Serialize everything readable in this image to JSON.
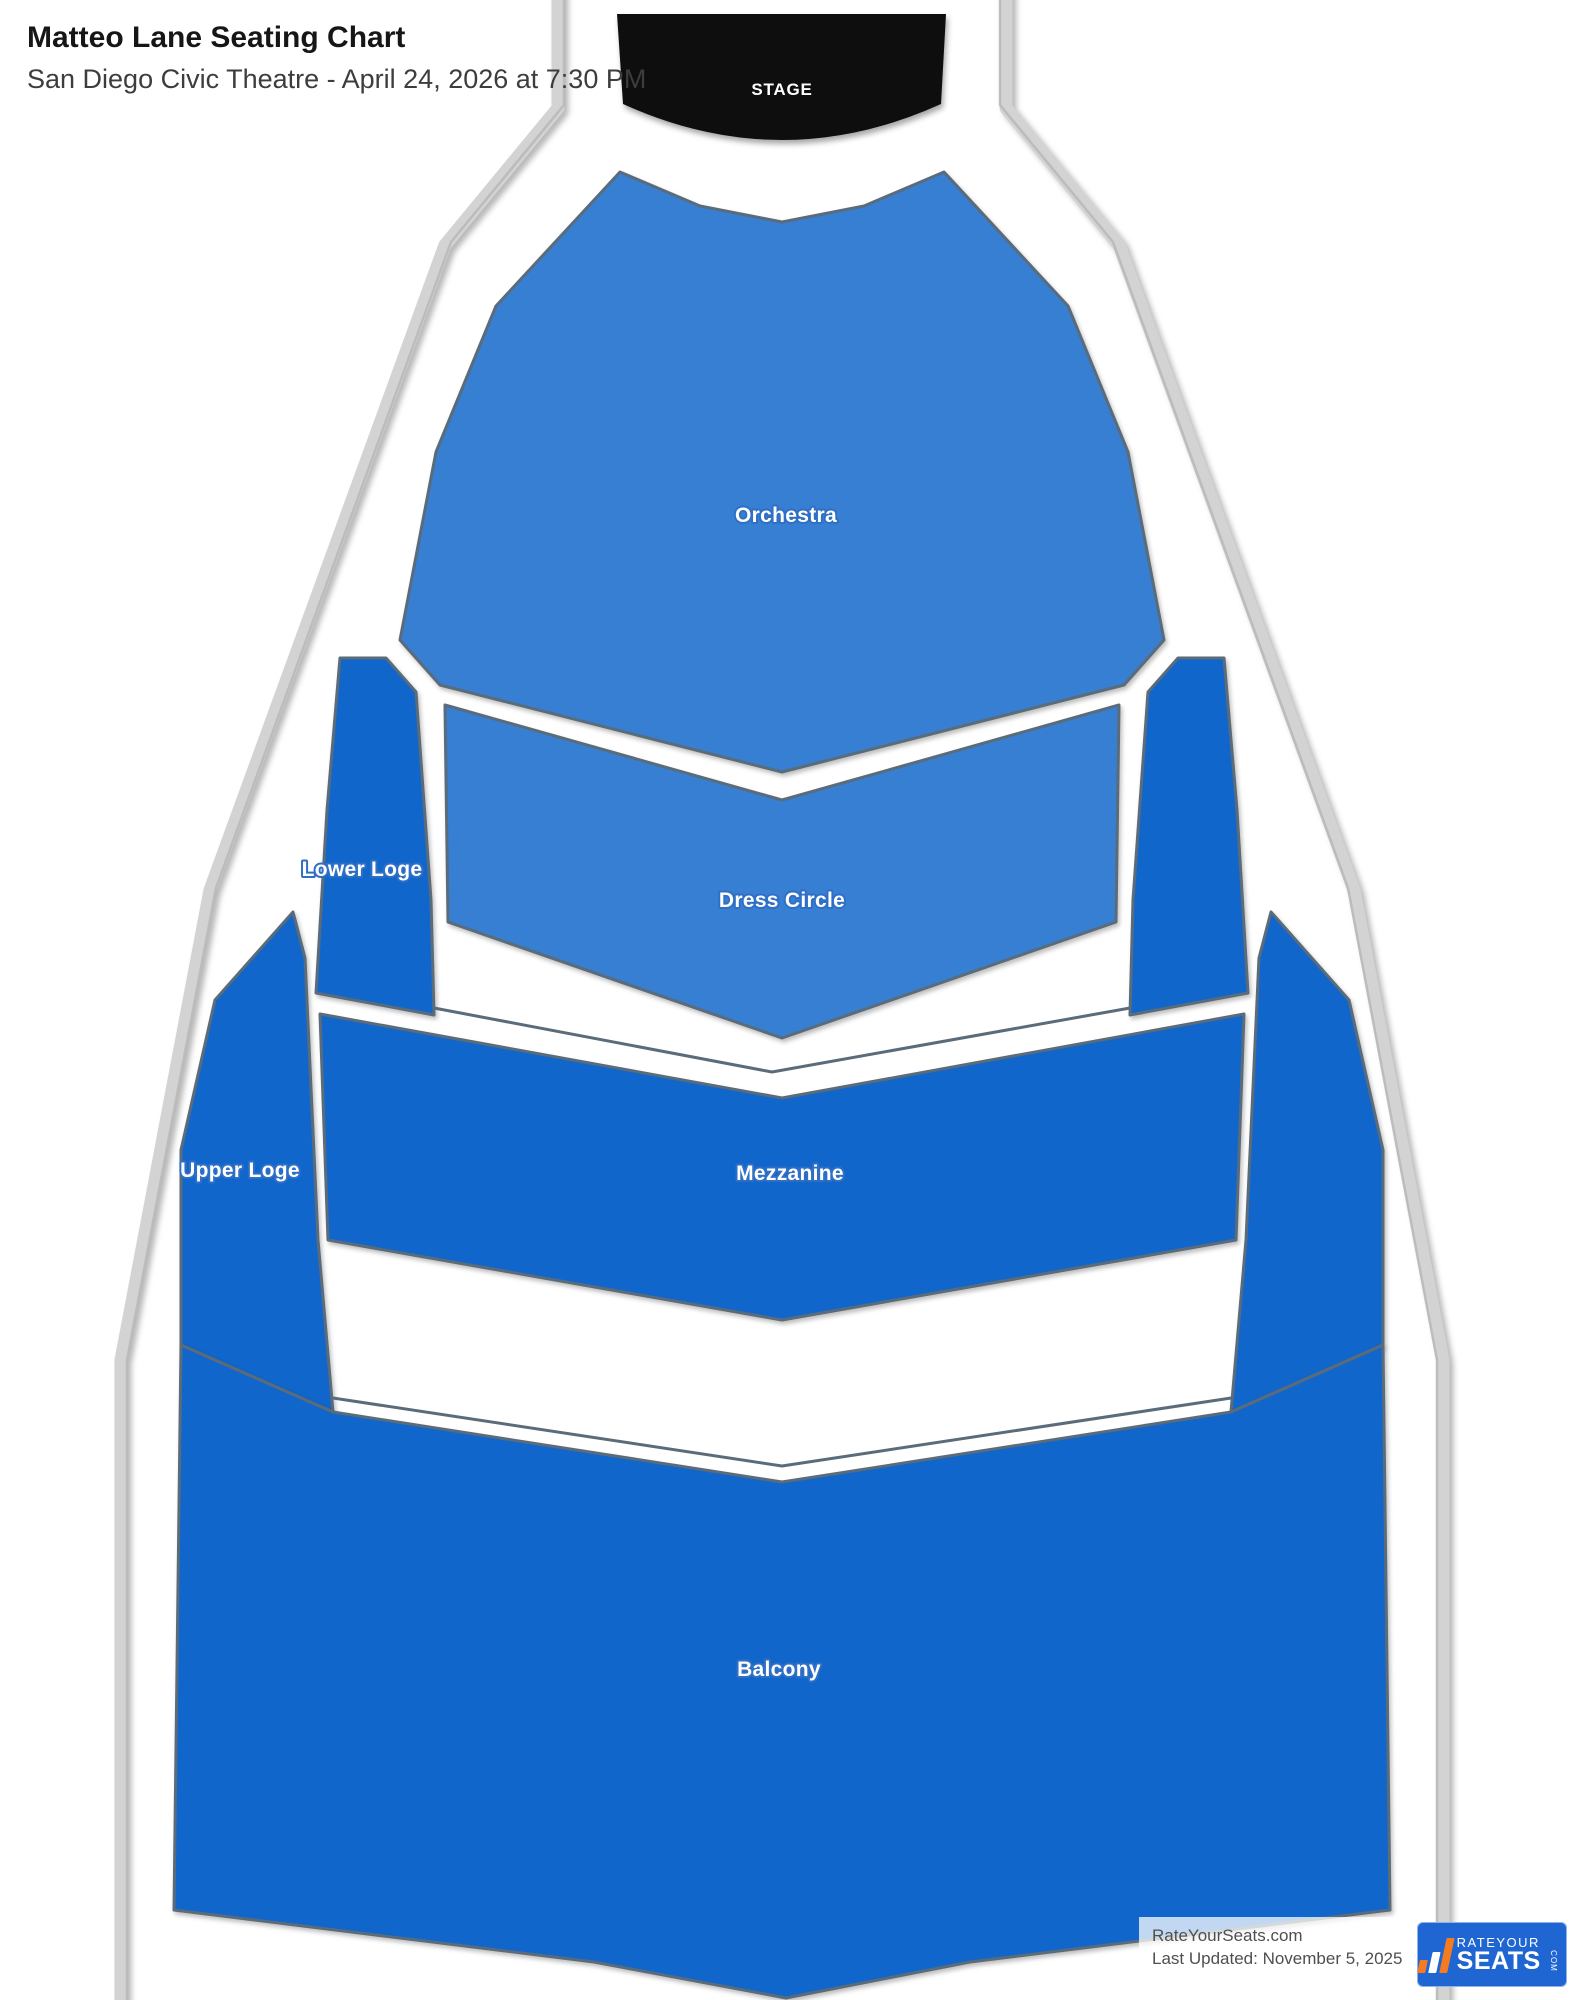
{
  "header": {
    "title": "Matteo Lane Seating Chart",
    "subtitle": "San Diego Civic Theatre - April 24, 2026 at 7:30 PM"
  },
  "colors": {
    "section_light_blue": "#377fd3",
    "section_dark_blue": "#1166cb",
    "section_stroke": "#5a6b7a",
    "stage_black": "#0e0e0e",
    "wall_gray": "#d3d3d3",
    "logo_blue": "#2066d2",
    "logo_orange": "#f47b20"
  },
  "map": {
    "stage": {
      "label": "STAGE",
      "path": "M 617,14 L 946,14 L 941,104 Q 782,176 623,104 Z",
      "label_pos": [
        782,
        95
      ],
      "font_size": 17
    },
    "walls": [
      "M 558,-12 L 558,108 L 445,245 L 210,890 L 121,1360 L 121,2012",
      "M 1006,-12 L 1006,108 L 1119,245 L 1354,890 L 1443,1360 L 1443,2012"
    ],
    "wall_inner_lines": [
      "M 564,-12 L 564,105 L 451,242 L 216,888 L 127,1360 L 127,2012",
      "M 1000,-12 L 1000,105 L 1113,242 L 1348,888 L 1437,1360 L 1437,2012"
    ],
    "rails": [
      "434,1008 772,1072 1130,1008",
      "333,1398 782,1466 1231,1398"
    ],
    "sections": [
      {
        "id": "orchestra",
        "label": "Orchestra",
        "tone": "light",
        "points": "620,172 700,206 782,222 864,206 944,172 1068,306 1128,452 1164,640 1124,685 782,772 440,685 400,640 436,452 496,306",
        "label_pos": [
          786,
          522
        ],
        "font_size": 21
      },
      {
        "id": "dress-circle",
        "label": "Dress Circle",
        "tone": "light",
        "points": "445,705 782,800 1119,705 1116,922 782,1038 448,922",
        "label_pos": [
          782,
          907
        ],
        "font_size": 21
      },
      {
        "id": "lower-loge-left",
        "label": "Lower Loge",
        "tone": "dark",
        "points": "340,658 386,658 416,692 431,900 434,1015 316,993 327,810",
        "label_pos": [
          362,
          876
        ],
        "font_size": 21
      },
      {
        "id": "lower-loge-right",
        "label": "",
        "tone": "dark",
        "points": "1224,658 1178,658 1148,692 1133,900 1130,1015 1248,993 1237,810",
        "label_pos": [
          1202,
          876
        ],
        "font_size": 21
      },
      {
        "id": "upper-loge-left",
        "label": "Upper Loge",
        "tone": "dark",
        "points": "293,912 305,958 318,1240 333,1412 181,1345 181,1150 215,1000",
        "label_pos": [
          240,
          1177
        ],
        "font_size": 21
      },
      {
        "id": "upper-loge-right",
        "label": "",
        "tone": "dark",
        "points": "1271,912 1259,958 1246,1240 1231,1412 1383,1345 1383,1150 1349,1000",
        "label_pos": [
          1324,
          1177
        ],
        "font_size": 21
      },
      {
        "id": "mezzanine",
        "label": "Mezzanine",
        "tone": "dark",
        "points": "320,1014 782,1098 1244,1014 1236,1240 782,1320 328,1240",
        "label_pos": [
          790,
          1180
        ],
        "font_size": 21
      },
      {
        "id": "balcony",
        "label": "Balcony",
        "tone": "dark",
        "points": "181,1345 333,1412 782,1482 1231,1412 1383,1345 1390,1910 970,1962 786,1998 594,1962 174,1910",
        "label_pos": [
          779,
          1676
        ],
        "font_size": 21
      }
    ]
  },
  "watermark": {
    "site": "RateYourSeats.com",
    "updated": "Last Updated: November 5, 2025"
  },
  "logo": {
    "line1": "RATEYOUR",
    "line2": "SEATS",
    "suffix": "COM"
  }
}
